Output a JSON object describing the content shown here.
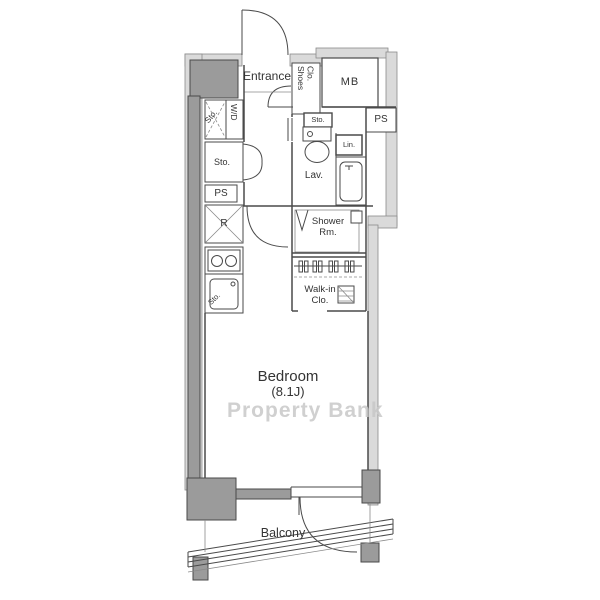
{
  "plan": {
    "labels": {
      "entrance": "Entrance",
      "shoes_line1": "Shoes",
      "shoes_line2": "Clo.",
      "mb": "MB",
      "ps_top": "PS",
      "sto_above_toilet": "Sto.",
      "lin": "Lin.",
      "lav": "Lav.",
      "sto_left": "Sto.",
      "wd": "W/D",
      "sto_closet": "Sto.",
      "ps_left": "PS",
      "fridge": "R",
      "sto_sink": "Sto.",
      "shower_line1": "Shower",
      "shower_line2": "Rm.",
      "walkin_line1": "Walk-in",
      "walkin_line2": "Clo.",
      "bedroom_name": "Bedroom",
      "bedroom_size": "(8.1J)",
      "balcony": "Balcony"
    },
    "watermark": "Property Bank",
    "colors": {
      "wall_dark": "#9b9b9b",
      "wall_light": "#dadada",
      "line": "#4a4a4a",
      "text": "#333333",
      "watermark": "#c8c8c8",
      "background": "#ffffff"
    }
  }
}
